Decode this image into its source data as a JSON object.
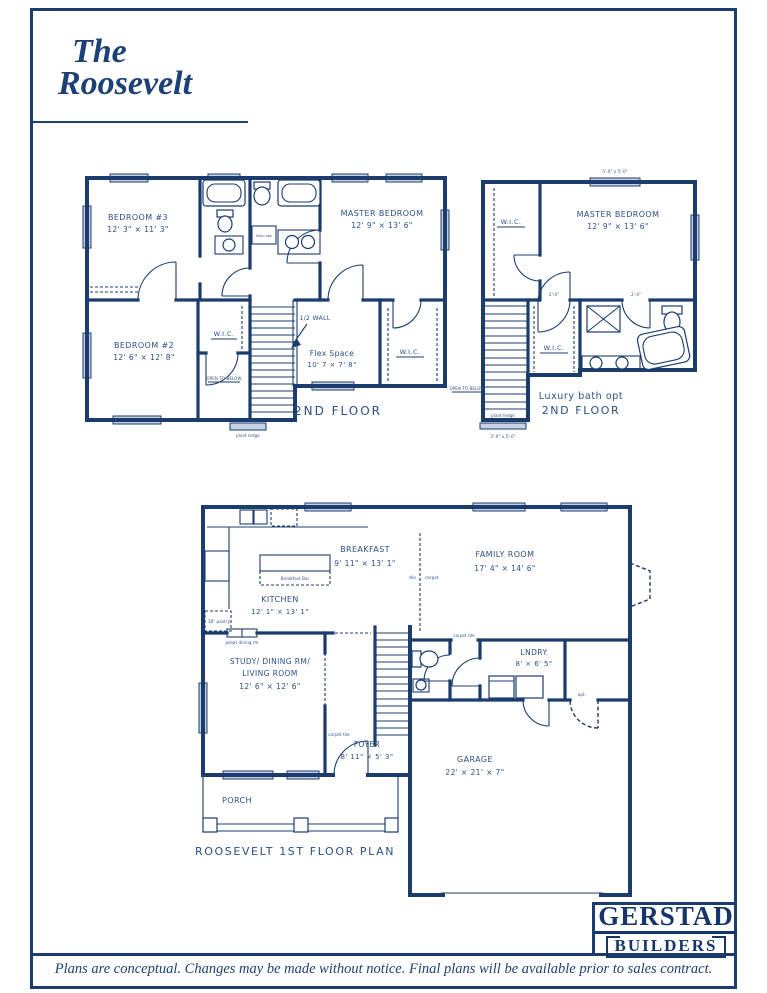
{
  "colors": {
    "wall": "#1b3c6d",
    "text": "#2d4f85",
    "window": "#c6d1e1"
  },
  "title": {
    "line1": "The",
    "line2": "Roosevelt"
  },
  "sf": {
    "bedroom3_name": "BEDROOM #3",
    "bedroom3_dims": "12' 3\" × 11' 3\"",
    "master_name": "MASTER BEDROOM",
    "master_dims": "12' 9\" × 13' 6\"",
    "bedroom2_name": "BEDROOM #2",
    "bedroom2_dims": "12' 6\" × 12' 8\"",
    "wic1": "W.I.C.",
    "wic2": "W.I.C.",
    "half_wall": "1/2 WALL",
    "flex_name": "Flex Space",
    "flex_dims": "10' 7 × 7' 8\"",
    "linen": "linen cab",
    "open_below": "OPEN TO BELOW",
    "plant_ledge": "plant ledge",
    "floor_label": "2ND FLOOR"
  },
  "lux": {
    "window_dim": "5'-0\" x 5'-0\"",
    "master_name": "MASTER BEDROOM",
    "master_dims": "12' 9\" × 13' 6\"",
    "wic_top": "W.I.C.",
    "wic_bottom": "W.I.C.",
    "door_dim_a": "2'-4\"",
    "door_dim_b": "2'-4\"",
    "open_below": "OPEN TO BELOW",
    "plant_ledge": "plant ledge",
    "ledge_dim": "3'-0\" x 5'-0\"",
    "caption1": "Luxury bath opt",
    "caption2": "2ND FLOOR"
  },
  "ff": {
    "breakfast_name": "BREAKFAST",
    "breakfast_dims": "9' 11\" × 13' 1\"",
    "kitchen_name": "KITCHEN",
    "kitchen_dims": "12' 1\" × 13' 1\"",
    "breakfast_bar": "Breakfast Bar",
    "pantry": "18\" pantry",
    "opt_dining": "w/opt dining rm",
    "tile": "tile",
    "carpet": "carpet",
    "family_name": "FAMILY ROOM",
    "family_dims": "17' 4\" × 14' 6\"",
    "study_line1": "STUDY/ DINING RM/",
    "study_line2": "LIVING ROOM",
    "study_dims": "12' 6\" × 12' 6\"",
    "foyer_name": "FOYER",
    "foyer_dims": "8' 11\" × 5' 3\"",
    "carpet_tile_foyer": "carpet tile",
    "carpet_tile_hall": "carpet tile",
    "lndry_name": "LNDRY",
    "lndry_dims": "8' × 6' 5\"",
    "opt_door": "opt.",
    "garage_name": "GARAGE",
    "garage_dims": "22' × 21' × 7\"",
    "porch": "PORCH",
    "caption": "ROOSEVELT 1ST FLOOR PLAN"
  },
  "logo": {
    "name": "GERSTAD",
    "sub": "BUILDERS"
  },
  "footer": {
    "disclaimer": "Plans are conceptual. Changes may be made without notice. Final plans will be available prior to sales contract."
  }
}
